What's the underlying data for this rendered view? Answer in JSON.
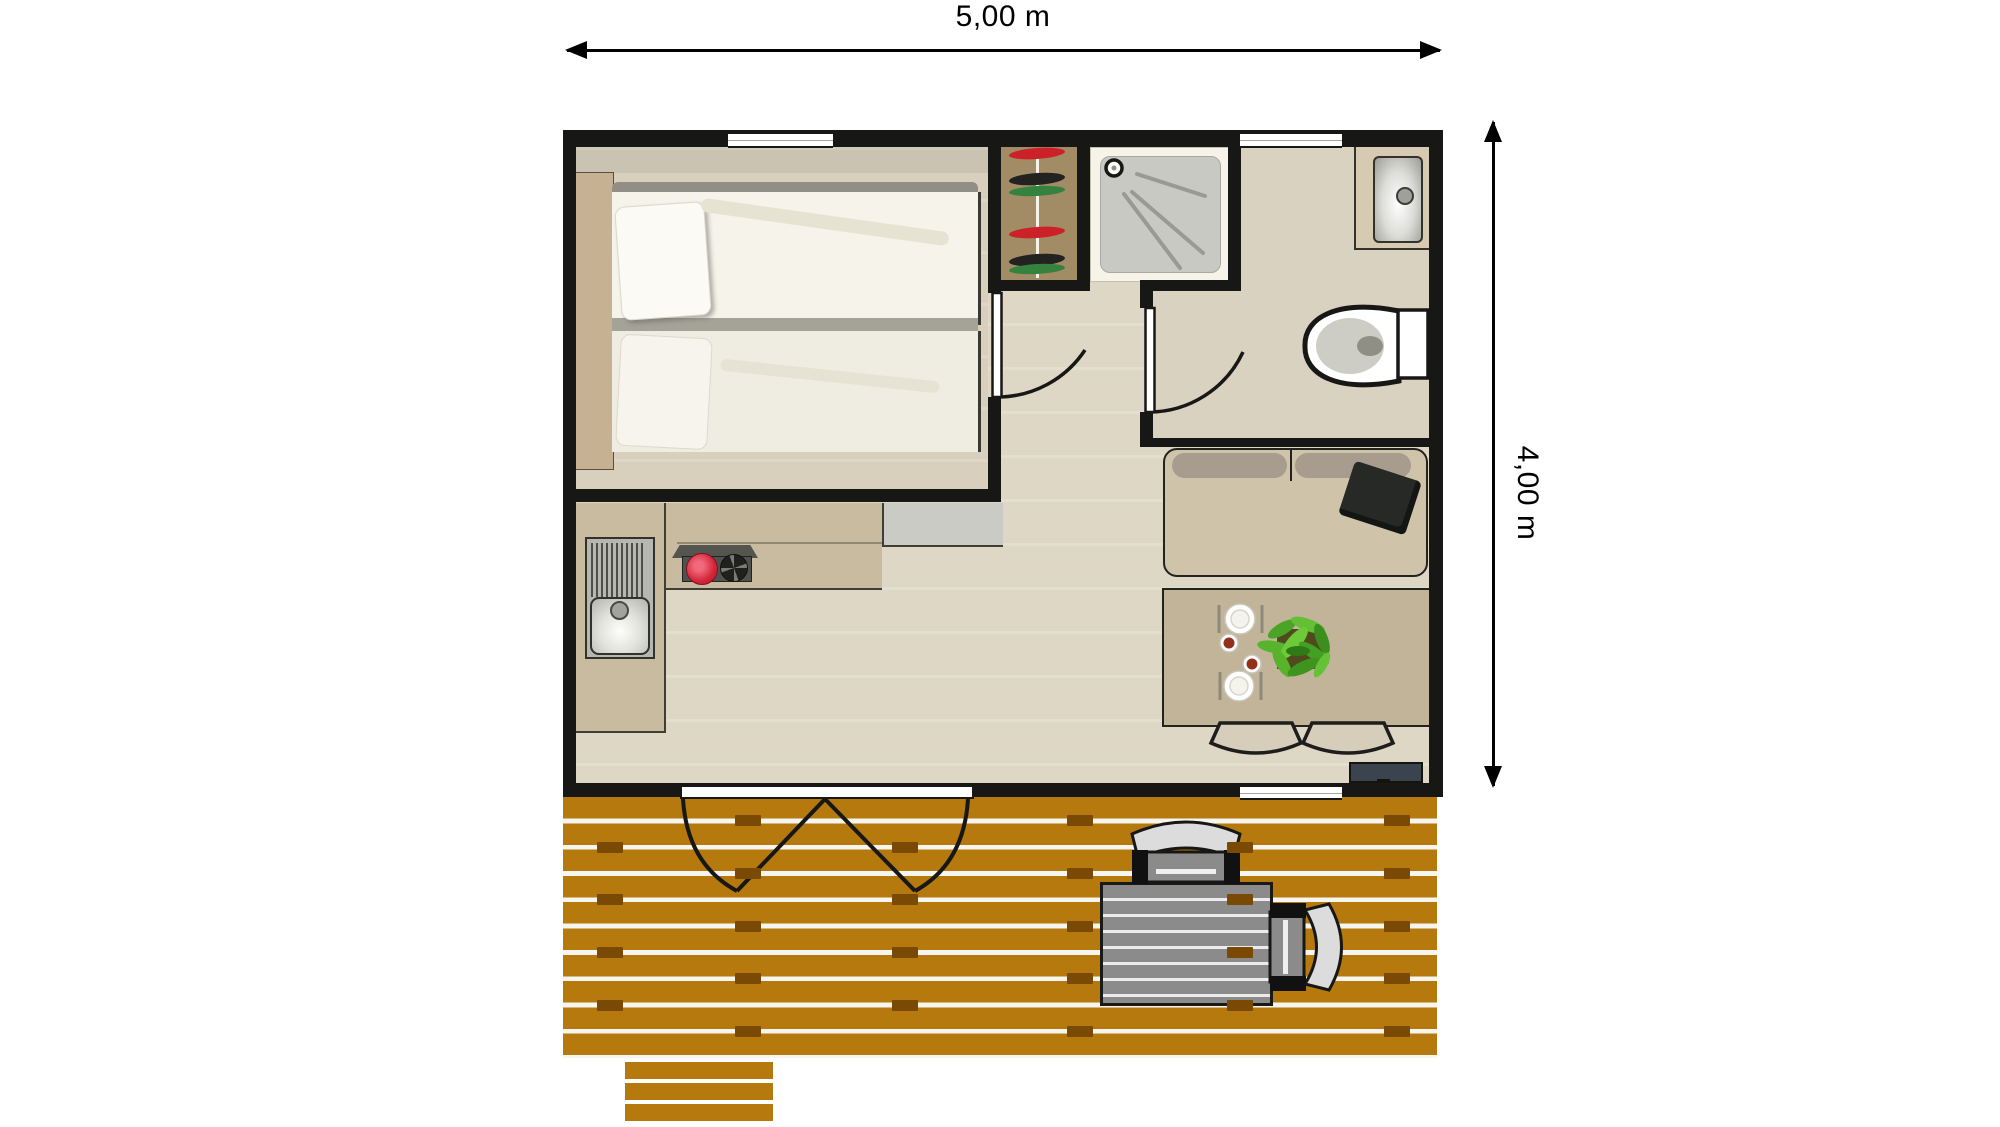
{
  "plan": {
    "type": "floor-plan-top-view",
    "dimensions": {
      "width_label": "5,00 m",
      "height_label": "4,00 m"
    },
    "rooms": [
      "bedroom",
      "shower-room",
      "bathroom",
      "living-kitchen",
      "terrace"
    ],
    "fixtures": {
      "bedroom": [
        "double-bed",
        "headboard",
        "pillows",
        "window"
      ],
      "shower_room": [
        "wardrobe-with-clothes",
        "shower-tray",
        "shower-head"
      ],
      "bathroom": [
        "washbasin-counter",
        "toilet",
        "window",
        "interior-door"
      ],
      "living_kitchen": [
        "kitchen-sink",
        "drainboard",
        "two-burner-stove",
        "worktop",
        "appliance-block",
        "sofa",
        "black-cushion",
        "dining-table",
        "two-place-settings",
        "plant",
        "two-dining-chairs",
        "tv-on-stand",
        "bedroom-door",
        "french-entrance-door",
        "window"
      ],
      "terrace": [
        "wood-deck-planks",
        "terrace-table",
        "two-terrace-chairs",
        "steps"
      ]
    },
    "colors": {
      "wall": "#171715",
      "bedroom_floor": "#d8d0bd",
      "living_floor": "#ded7c5",
      "bathroom_floor": "#dad2c0",
      "shower_room_base": "#f6f3e9",
      "shower_tray": "#c7c9c2",
      "wardrobe_wood": "#a28c66",
      "clothes_red": "#cc2128",
      "clothes_black": "#222220",
      "clothes_green": "#35823f",
      "counter_tan": "#c9bb9f",
      "appliance_gray": "#cbcbc5",
      "burner_on_red": "#d32638",
      "sofa_body": "#cfc3a9",
      "sofa_cushion": "#a79c8e",
      "sofa_pillow_black": "#262926",
      "dining_table": "#c2b499",
      "cup_red": "#93301c",
      "plant_green": "#58b32c",
      "tv_slate": "#3a434e",
      "deck_wood": "#b5790e",
      "deck_joint": "#7a4a05",
      "deck_furniture_gray": "#8b8b8b",
      "deck_chair_back": "#dcdcdc",
      "dimension_arrow": "#000000"
    }
  }
}
